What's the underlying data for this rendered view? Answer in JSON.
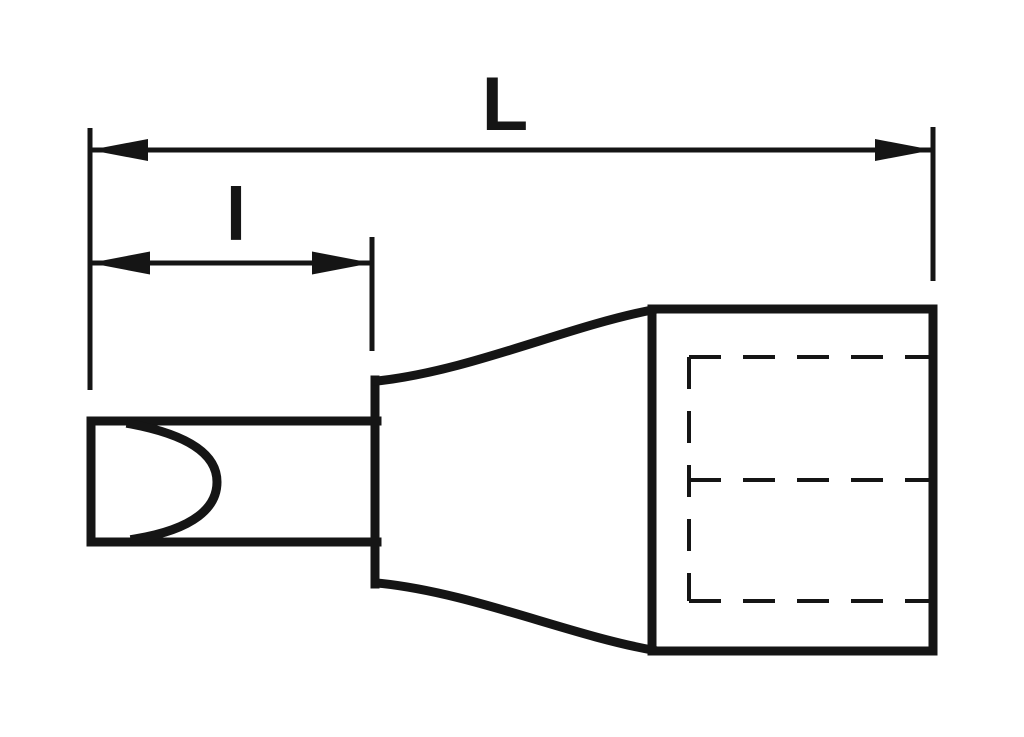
{
  "drawing": {
    "background_color": "#ffffff",
    "line_color": "#151515",
    "labels": {
      "overall_length": "L",
      "bit_length": "l"
    },
    "elements": {
      "dimension_overall": "overall-length-dimension",
      "dimension_bit": "bit-length-dimension",
      "bit_blade": "slotted-bit-blade",
      "bit_tip": "blade-grind-curve",
      "collar": "tapered-collar",
      "socket_body": "socket-body",
      "hidden_lines": "square-drive-hidden-lines"
    }
  }
}
